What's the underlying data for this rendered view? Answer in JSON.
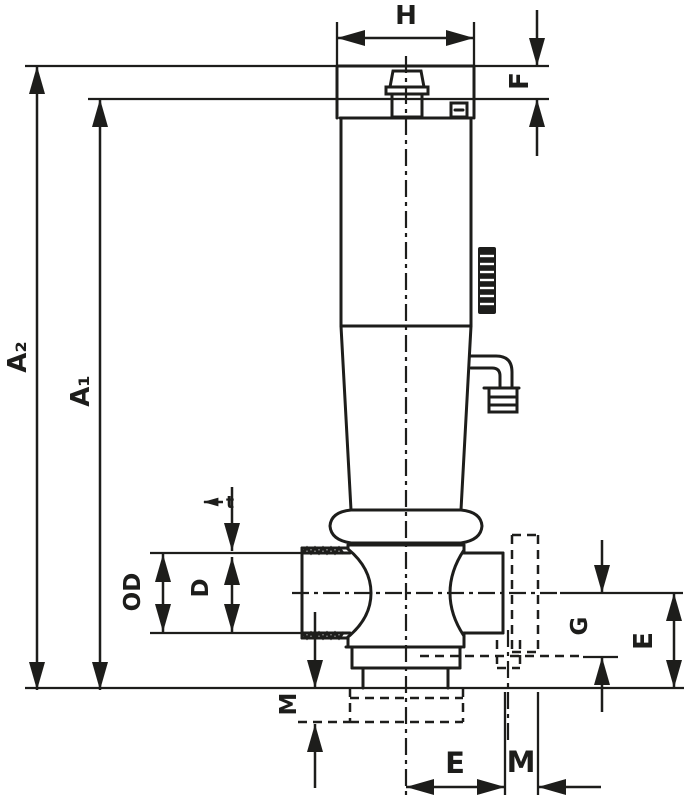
{
  "drawing": {
    "kind": "valve-dimensional-drawing",
    "background_color": "#ffffff",
    "line_color": "#1d1d1b",
    "labels": {
      "h": "H",
      "f": "F",
      "a2": "A₂",
      "a1": "A₁",
      "t": "t",
      "od": "OD",
      "d": "D",
      "m_left": "M",
      "g": "G",
      "e_right": "E",
      "e_bottom": "E",
      "m_bottom": "M"
    }
  }
}
